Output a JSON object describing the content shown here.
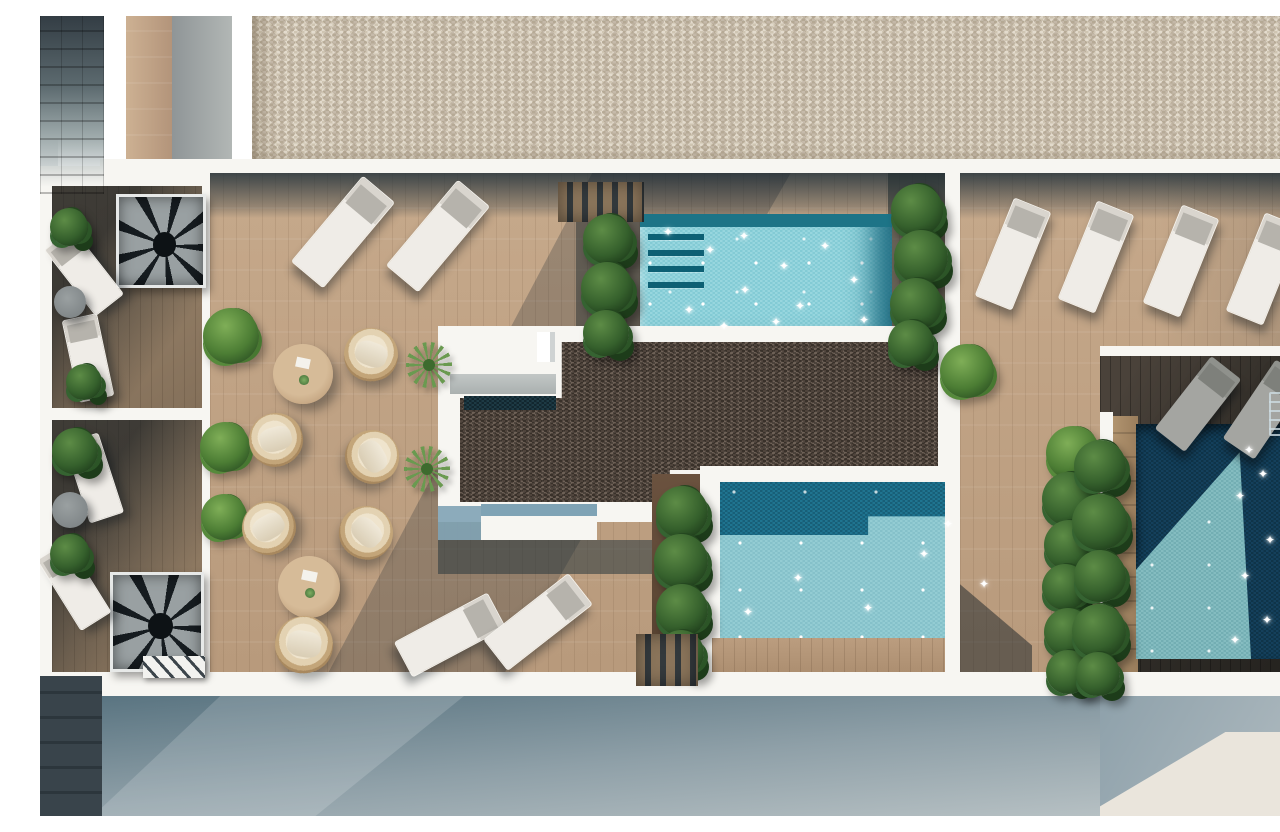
{
  "meta": {
    "title": "Aerial 3D render — rooftop terrace with three pools",
    "description": "Top-down architectural rendering of a rooftop terrace: wooden deck with sun loungers, wicker chairs and round tables, a light turquoise pool with steps, a larger two-tone pool, a deep shaded plunge pool with ladder, a dark gravel roof block, private balconies with spiral staircases on the left, and a cream gravel roof strip across the top."
  },
  "scene": {
    "palette": {
      "white": "#f7f6f2",
      "deckA": "#c6a98b",
      "deckB": "#b89a7c",
      "gravelLightA": "#e3dbcd",
      "gravelLightB": "#cfc5b2",
      "gravelDarkA": "#6e6157",
      "gravelDarkB": "#4d443c",
      "pool1Deep": "#1d7487",
      "shadowBlue": "#7fa3b5",
      "groundBlueA": "#57727f",
      "groundBlueB": "#b6c0c3",
      "groundCream": "#eae5dc"
    },
    "glyphs": {
      "sparkle": "✦"
    },
    "items": [
      {
        "t": "spiral-stair",
        "n": "spiral-staircase-upper",
        "b": [
          76,
          178,
          90,
          94,
          0
        ]
      },
      {
        "t": "spiral-stair",
        "n": "spiral-staircase-lower",
        "b": [
          70,
          556,
          94,
          100,
          0
        ]
      },
      {
        "t": "hatch-steps",
        "n": "stair-landing",
        "b": [
          103,
          640,
          62,
          22,
          0
        ]
      },
      {
        "t": "lounger",
        "n": "balcony-lounger",
        "b": [
          26,
          214,
          36,
          84,
          -38
        ]
      },
      {
        "t": "lounger",
        "n": "balcony-lounger",
        "b": [
          30,
          300,
          36,
          84,
          -12
        ]
      },
      {
        "t": "lounger",
        "n": "balcony-lounger",
        "b": [
          36,
          420,
          36,
          84,
          -18
        ]
      },
      {
        "t": "lounger",
        "n": "balcony-lounger",
        "b": [
          16,
          528,
          36,
          84,
          -32
        ]
      },
      {
        "t": "table-gray",
        "n": "balcony-side-table",
        "b": [
          14,
          270,
          32,
          32,
          0
        ]
      },
      {
        "t": "table-gray",
        "n": "balcony-side-table",
        "b": [
          12,
          476,
          36,
          36,
          0
        ]
      },
      {
        "t": "plant",
        "n": "balcony-plant",
        "b": [
          10,
          192,
          38,
          38,
          0
        ]
      },
      {
        "t": "plant",
        "n": "balcony-plant",
        "b": [
          26,
          348,
          36,
          36,
          0
        ]
      },
      {
        "t": "plant",
        "n": "balcony-plant",
        "b": [
          12,
          412,
          46,
          46,
          0
        ]
      },
      {
        "t": "plant",
        "n": "balcony-plant",
        "b": [
          10,
          518,
          40,
          40,
          0
        ]
      },
      {
        "t": "bush",
        "n": "deck-bush",
        "b": [
          163,
          292,
          56,
          56,
          0
        ]
      },
      {
        "t": "bush",
        "n": "deck-bush",
        "b": [
          160,
          406,
          50,
          50,
          0
        ]
      },
      {
        "t": "bush",
        "n": "deck-bush",
        "b": [
          161,
          478,
          46,
          46,
          0
        ]
      },
      {
        "t": "lounger",
        "n": "sun-lounger",
        "b": [
          282,
          160,
          42,
          112,
          40
        ]
      },
      {
        "t": "lounger",
        "n": "sun-lounger",
        "b": [
          377,
          164,
          42,
          112,
          40
        ]
      },
      {
        "t": "steps",
        "n": "wood-steps-upper",
        "b": [
          518,
          166,
          86,
          40,
          0
        ]
      },
      {
        "t": "table-wood",
        "n": "round-dining-table",
        "b": [
          233,
          328,
          60,
          60,
          0
        ]
      },
      {
        "t": "chair",
        "n": "wicker-chair",
        "b": [
          304,
          312,
          54,
          54,
          20
        ]
      },
      {
        "t": "chair",
        "n": "wicker-chair",
        "b": [
          209,
          397,
          54,
          54,
          -15
        ]
      },
      {
        "t": "chair",
        "n": "wicker-chair",
        "b": [
          305,
          414,
          54,
          54,
          60
        ]
      },
      {
        "t": "yucca",
        "n": "yucca-plant",
        "b": [
          366,
          326,
          46,
          46,
          0
        ]
      },
      {
        "t": "yucca",
        "n": "yucca-plant",
        "b": [
          364,
          430,
          46,
          46,
          0
        ]
      },
      {
        "t": "chair",
        "n": "wicker-chair",
        "b": [
          202,
          485,
          54,
          54,
          -30
        ]
      },
      {
        "t": "chair",
        "n": "wicker-chair",
        "b": [
          299,
          490,
          54,
          54,
          45
        ]
      },
      {
        "t": "table-wood",
        "n": "round-dining-table",
        "b": [
          238,
          540,
          62,
          62,
          0
        ]
      },
      {
        "t": "chair",
        "n": "wicker-chair",
        "b": [
          235,
          600,
          58,
          58,
          10
        ]
      },
      {
        "t": "lounger",
        "n": "sun-lounger",
        "b": [
          390,
          566,
          40,
          106,
          62
        ]
      },
      {
        "t": "lounger",
        "n": "sun-lounger",
        "b": [
          478,
          552,
          40,
          108,
          52
        ]
      },
      {
        "t": "plant",
        "n": "poolside-plant",
        "b": [
          543,
          198,
          50,
          50,
          0
        ]
      },
      {
        "t": "plant",
        "n": "poolside-plant",
        "b": [
          541,
          246,
          52,
          52,
          0
        ]
      },
      {
        "t": "plant",
        "n": "poolside-plant",
        "b": [
          543,
          294,
          46,
          46,
          0
        ]
      },
      {
        "t": "plant",
        "n": "poolside-plant",
        "b": [
          851,
          168,
          52,
          52,
          0
        ]
      },
      {
        "t": "plant",
        "n": "poolside-plant",
        "b": [
          854,
          214,
          54,
          54,
          0
        ]
      },
      {
        "t": "plant",
        "n": "poolside-plant",
        "b": [
          850,
          262,
          52,
          52,
          0
        ]
      },
      {
        "t": "plant",
        "n": "poolside-plant",
        "b": [
          848,
          304,
          46,
          46,
          0
        ]
      },
      {
        "t": "bush",
        "n": "deck-bush",
        "b": [
          900,
          328,
          54,
          54,
          0
        ]
      },
      {
        "t": "bush",
        "n": "deck-bush",
        "b": [
          1006,
          410,
          54,
          54,
          0
        ]
      },
      {
        "t": "plant",
        "n": "poolside-plant",
        "b": [
          616,
          470,
          52,
          52,
          0
        ]
      },
      {
        "t": "plant",
        "n": "poolside-plant",
        "b": [
          614,
          518,
          54,
          54,
          0
        ]
      },
      {
        "t": "plant",
        "n": "poolside-plant",
        "b": [
          616,
          568,
          52,
          52,
          0
        ]
      },
      {
        "t": "plant",
        "n": "poolside-plant",
        "b": [
          618,
          614,
          46,
          46,
          0
        ]
      },
      {
        "t": "plant",
        "n": "poolside-plant",
        "b": [
          1002,
          456,
          54,
          54,
          0
        ]
      },
      {
        "t": "plant",
        "n": "poolside-plant",
        "b": [
          1004,
          504,
          50,
          50,
          0
        ]
      },
      {
        "t": "plant",
        "n": "poolside-plant",
        "b": [
          1002,
          548,
          46,
          46,
          0
        ]
      },
      {
        "t": "plant",
        "n": "poolside-plant",
        "b": [
          1004,
          592,
          48,
          48,
          0
        ]
      },
      {
        "t": "plant",
        "n": "poolside-plant",
        "b": [
          1006,
          634,
          44,
          44,
          0
        ]
      },
      {
        "t": "lounger",
        "n": "sun-lounger",
        "b": [
          953,
          185,
          40,
          106,
          22
        ]
      },
      {
        "t": "lounger",
        "n": "sun-lounger",
        "b": [
          1036,
          188,
          40,
          106,
          22
        ]
      },
      {
        "t": "lounger",
        "n": "sun-lounger",
        "b": [
          1121,
          192,
          40,
          106,
          22
        ]
      },
      {
        "t": "lounger",
        "n": "sun-lounger",
        "b": [
          1204,
          200,
          40,
          106,
          22
        ]
      },
      {
        "t": "lounger-gray",
        "n": "shaded-lounger",
        "b": [
          1139,
          342,
          38,
          92,
          38
        ]
      },
      {
        "t": "lounger-gray",
        "n": "shaded-lounger",
        "b": [
          1206,
          346,
          38,
          95,
          34
        ]
      },
      {
        "t": "ladder",
        "n": "pool-ladder",
        "b": [
          1229,
          376,
          28,
          44,
          0
        ]
      },
      {
        "t": "plant",
        "n": "poolside-plant",
        "b": [
          1034,
          424,
          52,
          52,
          0
        ]
      },
      {
        "t": "plant",
        "n": "poolside-plant",
        "b": [
          1032,
          478,
          56,
          56,
          0
        ]
      },
      {
        "t": "plant",
        "n": "poolside-plant",
        "b": [
          1034,
          534,
          52,
          52,
          0
        ]
      },
      {
        "t": "plant",
        "n": "poolside-plant",
        "b": [
          1032,
          588,
          54,
          54,
          0
        ]
      },
      {
        "t": "plant",
        "n": "poolside-plant",
        "b": [
          1036,
          636,
          44,
          44,
          0
        ]
      },
      {
        "t": "steps",
        "n": "wood-steps-lower",
        "b": [
          596,
          618,
          62,
          52,
          0
        ]
      },
      {
        "t": "sparkle",
        "n": "water-sparkle",
        "b": [
          622,
          210,
          12,
          12,
          0
        ]
      },
      {
        "t": "sparkle",
        "n": "water-sparkle",
        "b": [
          664,
          228,
          12,
          12,
          0
        ]
      },
      {
        "t": "sparkle",
        "n": "water-sparkle",
        "b": [
          698,
          214,
          12,
          12,
          0
        ]
      },
      {
        "t": "sparkle",
        "n": "water-sparkle",
        "b": [
          738,
          244,
          12,
          12,
          0
        ]
      },
      {
        "t": "sparkle",
        "n": "water-sparkle",
        "b": [
          779,
          224,
          12,
          12,
          0
        ]
      },
      {
        "t": "sparkle",
        "n": "water-sparkle",
        "b": [
          699,
          268,
          12,
          12,
          0
        ]
      },
      {
        "t": "sparkle",
        "n": "water-sparkle",
        "b": [
          643,
          288,
          12,
          12,
          0
        ]
      },
      {
        "t": "sparkle",
        "n": "water-sparkle",
        "b": [
          754,
          284,
          12,
          12,
          0
        ]
      },
      {
        "t": "sparkle",
        "n": "water-sparkle",
        "b": [
          808,
          258,
          12,
          12,
          0
        ]
      },
      {
        "t": "sparkle",
        "n": "water-sparkle",
        "b": [
          818,
          298,
          12,
          12,
          0
        ]
      },
      {
        "t": "sparkle",
        "n": "water-sparkle",
        "b": [
          678,
          304,
          12,
          12,
          0
        ]
      },
      {
        "t": "sparkle",
        "n": "water-sparkle",
        "b": [
          730,
          300,
          12,
          12,
          0
        ]
      },
      {
        "t": "sparkle",
        "n": "water-sparkle",
        "b": [
          702,
          590,
          12,
          12,
          0
        ]
      },
      {
        "t": "sparkle",
        "n": "water-sparkle",
        "b": [
          752,
          556,
          12,
          12,
          0
        ]
      },
      {
        "t": "sparkle",
        "n": "water-sparkle",
        "b": [
          822,
          586,
          12,
          12,
          0
        ]
      },
      {
        "t": "sparkle",
        "n": "water-sparkle",
        "b": [
          878,
          532,
          12,
          12,
          0
        ]
      },
      {
        "t": "sparkle",
        "n": "water-sparkle",
        "b": [
          938,
          562,
          12,
          12,
          0
        ]
      },
      {
        "t": "sparkle",
        "n": "water-sparkle",
        "b": [
          902,
          502,
          12,
          12,
          0
        ]
      },
      {
        "t": "sparkle",
        "n": "water-sparkle",
        "b": [
          1203,
          428,
          12,
          12,
          0
        ]
      },
      {
        "t": "sparkle",
        "n": "water-sparkle",
        "b": [
          1217,
          452,
          12,
          12,
          0
        ]
      },
      {
        "t": "sparkle",
        "n": "water-sparkle",
        "b": [
          1194,
          474,
          12,
          12,
          0
        ]
      },
      {
        "t": "sparkle",
        "n": "water-sparkle",
        "b": [
          1224,
          518,
          12,
          12,
          0
        ]
      },
      {
        "t": "sparkle",
        "n": "water-sparkle",
        "b": [
          1199,
          554,
          12,
          12,
          0
        ]
      },
      {
        "t": "sparkle",
        "n": "water-sparkle",
        "b": [
          1221,
          598,
          12,
          12,
          0
        ]
      },
      {
        "t": "sparkle",
        "n": "water-sparkle",
        "b": [
          1189,
          618,
          12,
          12,
          0
        ]
      }
    ]
  }
}
